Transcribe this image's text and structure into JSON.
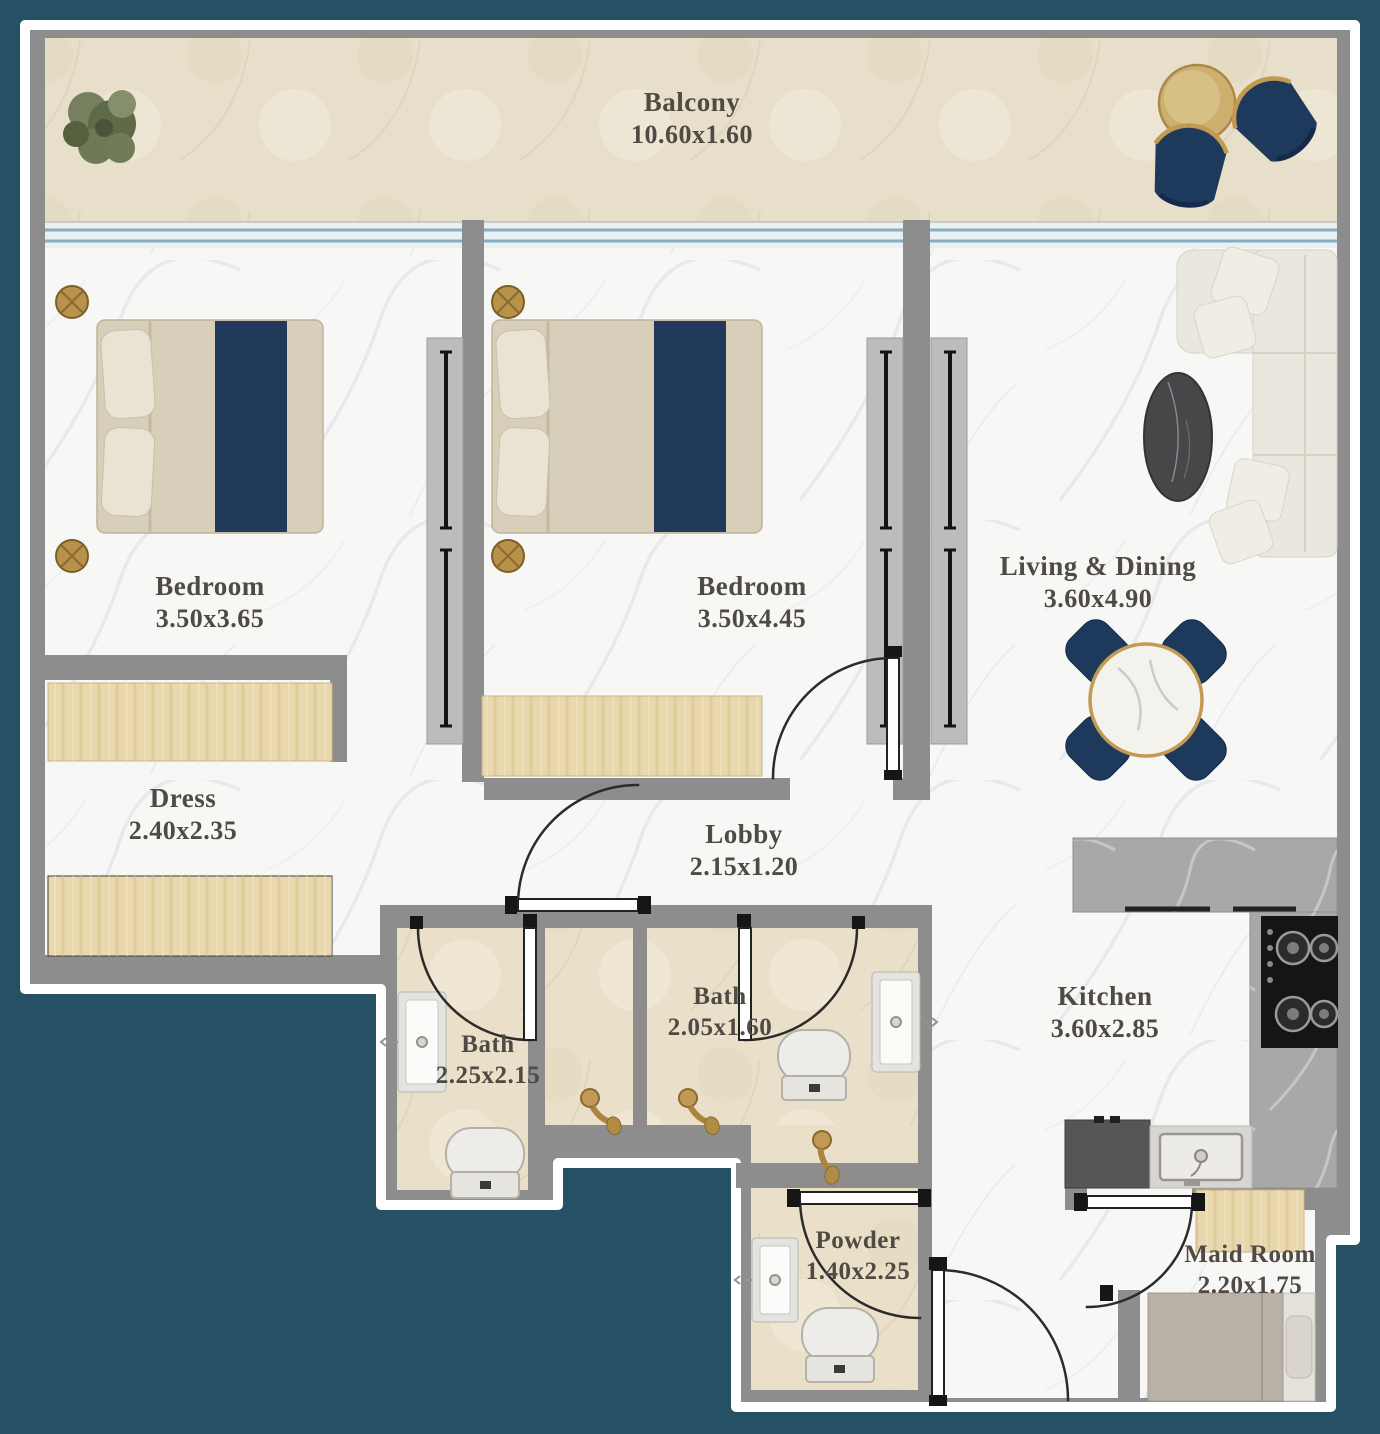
{
  "plan": {
    "rooms": [
      {
        "name": "Balcony",
        "dims": "10.60x1.60"
      },
      {
        "name": "Bedroom",
        "dims": "3.50x3.65"
      },
      {
        "name": "Bedroom",
        "dims": "3.50x4.45"
      },
      {
        "name": "Living & Dining",
        "dims": "3.60x4.90"
      },
      {
        "name": "Dress",
        "dims": "2.40x2.35"
      },
      {
        "name": "Lobby",
        "dims": "2.15x1.20"
      },
      {
        "name": "Bath",
        "dims": "2.25x2.15"
      },
      {
        "name": "Bath",
        "dims": "2.05x1.60"
      },
      {
        "name": "Kitchen",
        "dims": "3.60x2.85"
      },
      {
        "name": "Powder",
        "dims": "1.40x2.25"
      },
      {
        "name": "Maid Room",
        "dims": "2.20x1.75"
      }
    ],
    "colors": {
      "background_teal": "#265064",
      "wall_gray": "#8d8d8d",
      "accent_navy": "#21395a",
      "accent_gold": "#bb934e",
      "floor_white": "#f7f7f6",
      "floor_beige": "#eae0c9",
      "label_text": "#4f4b44"
    }
  }
}
